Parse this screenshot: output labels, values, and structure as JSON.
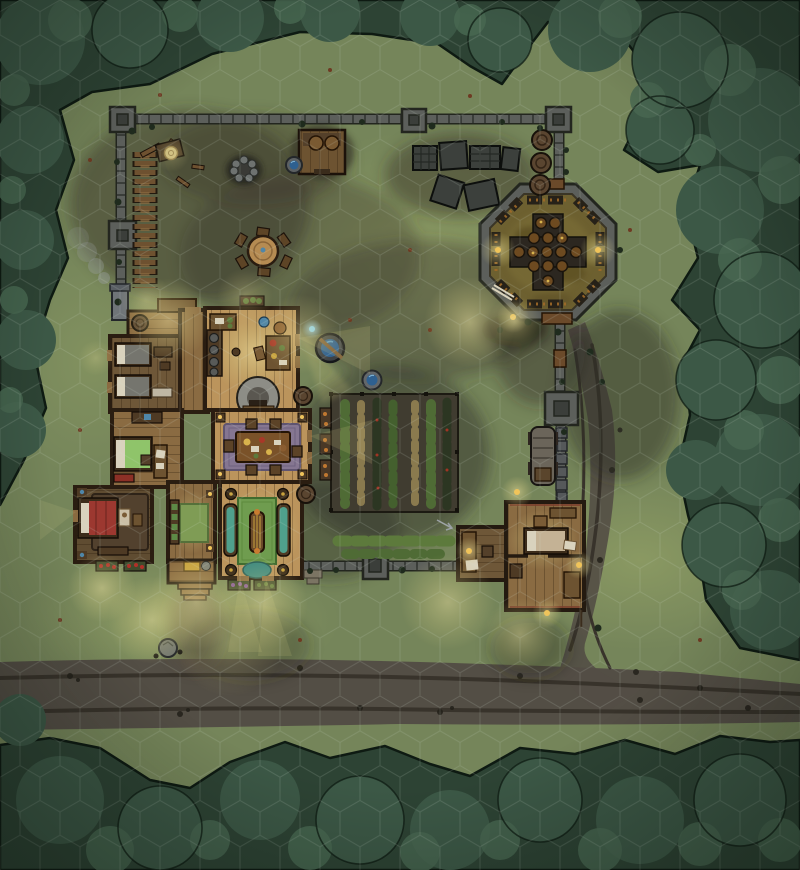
{
  "map": {
    "kind": "hex-grid battlemap",
    "features": [
      {
        "name": "perimeter-wall"
      },
      {
        "name": "watchtowers",
        "count": 5
      },
      {
        "name": "octagonal-walled-garden"
      },
      {
        "name": "main-house"
      },
      {
        "name": "kitchen"
      },
      {
        "name": "dining-room"
      },
      {
        "name": "living-room"
      },
      {
        "name": "bedrooms",
        "count": 4
      },
      {
        "name": "entry-hall"
      },
      {
        "name": "crop-garden"
      },
      {
        "name": "guest-house"
      },
      {
        "name": "covered-wagon"
      },
      {
        "name": "lumber-stacks"
      },
      {
        "name": "campfire-ring"
      },
      {
        "name": "round-table"
      },
      {
        "name": "storage-crates"
      },
      {
        "name": "wood-shed"
      },
      {
        "name": "wells",
        "count": 2
      },
      {
        "name": "barrels",
        "count": 3
      },
      {
        "name": "dirt-road"
      },
      {
        "name": "forest-border"
      }
    ]
  },
  "grid": {
    "type": "hex",
    "orientation": "pointy-top",
    "hex_width_px": 40,
    "color": "rgba(213,223,209,0.16)"
  },
  "palette": {
    "grass": "#75855a",
    "grass_light": "#92a266",
    "forest_base": "#2d4334",
    "forest_canopy": "#3c5846",
    "forest_highlight": "#486751",
    "forest_outline": "#101f16",
    "road": "#534e45",
    "road_rut": "#38332b",
    "dirt": "#45402f",
    "wall_stone": "#5c5f5b",
    "wall_outline": "#23261f",
    "wall_seam": "#3a3d39",
    "tower_inner": "#3b3e3a",
    "house_wall": "#2a1d11",
    "floor_lit": "#bb945c",
    "floor_mid": "#8a6b42",
    "floor_dim": "#6e5738",
    "floor_master": "#5f4c31",
    "porch": "#8a6a40",
    "rug_purple": "#857691",
    "rug_hall": "#7f9c55",
    "rug_living": "#6f9c4f",
    "rug_master": "#52412e",
    "bed_red": "#9c3830",
    "bed_green": "#8fc46a",
    "bed_grey": "#75756e",
    "linen": "#d9d2bd",
    "teal": "#4fa08c",
    "octagon_floor": "#6d6030",
    "soil": "#403c30",
    "crop_green": "#4f6b35",
    "crop_tan": "#8a7a4e",
    "vine": "#2c3622",
    "wood": "#6d5331",
    "wood_dark": "#4e3a24",
    "barrel": "#5a4530",
    "lumber": "#6e5130",
    "water": "#2e6090",
    "lantern": "#f0c45a",
    "smoke": "#9aa0a4"
  }
}
